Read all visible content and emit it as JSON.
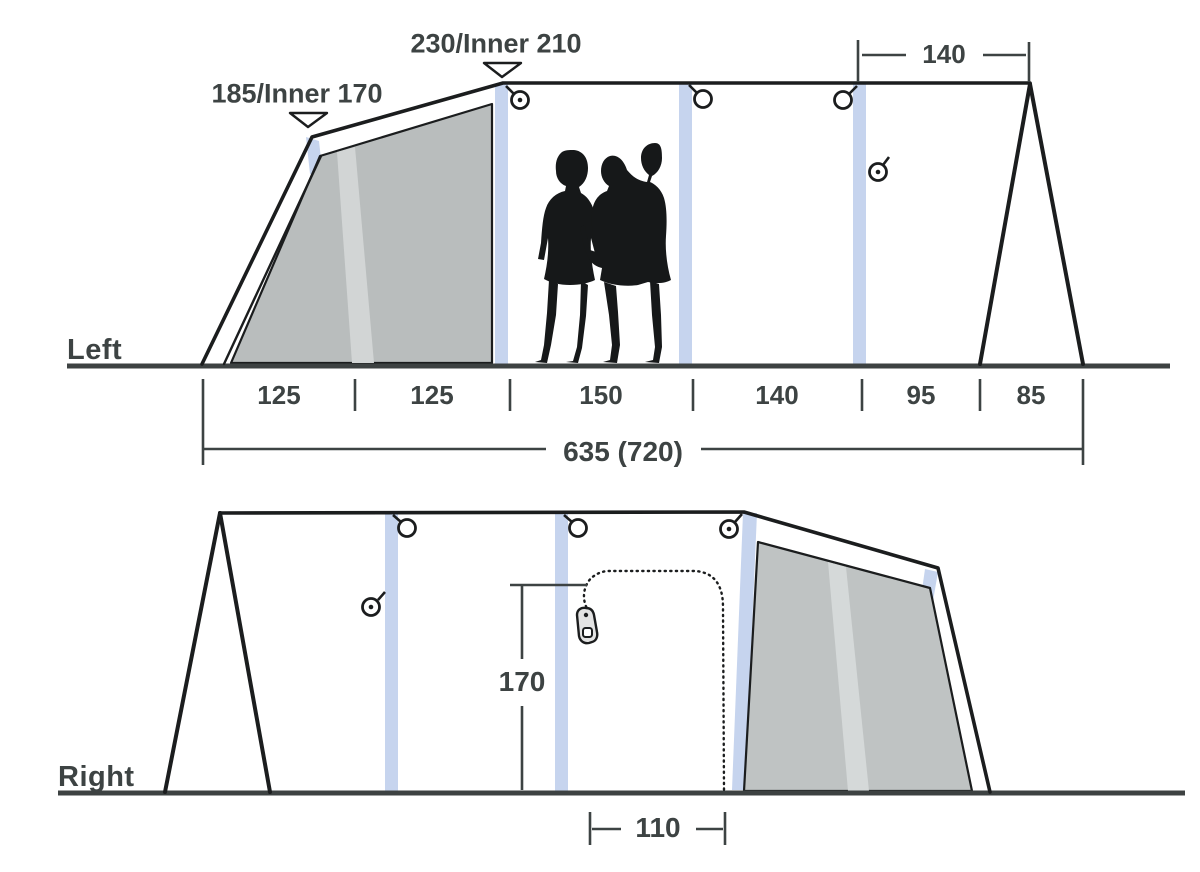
{
  "colors": {
    "background": "#ffffff",
    "line": "#1b1d1e",
    "dim": "#3d4343",
    "ground": "#3d4242",
    "pole": "#c6d4ee",
    "panel_upper": "#b9bdbd",
    "panel_upper_stripe": "#d2d5d5",
    "panel_lower": "#bfc3c3",
    "panel_lower_stripe": "#d5d9d9",
    "silhouette": "#161819"
  },
  "left_view": {
    "label": "Left",
    "front_height_label": "185/Inner 170",
    "peak_height_label": "230/Inner 210",
    "rear_top_width": "140",
    "floor_segments": [
      "125",
      "125",
      "150",
      "140",
      "95",
      "85"
    ],
    "total_length": "635 (720)"
  },
  "right_view": {
    "label": "Right",
    "door_height": "170",
    "door_width": "110"
  }
}
